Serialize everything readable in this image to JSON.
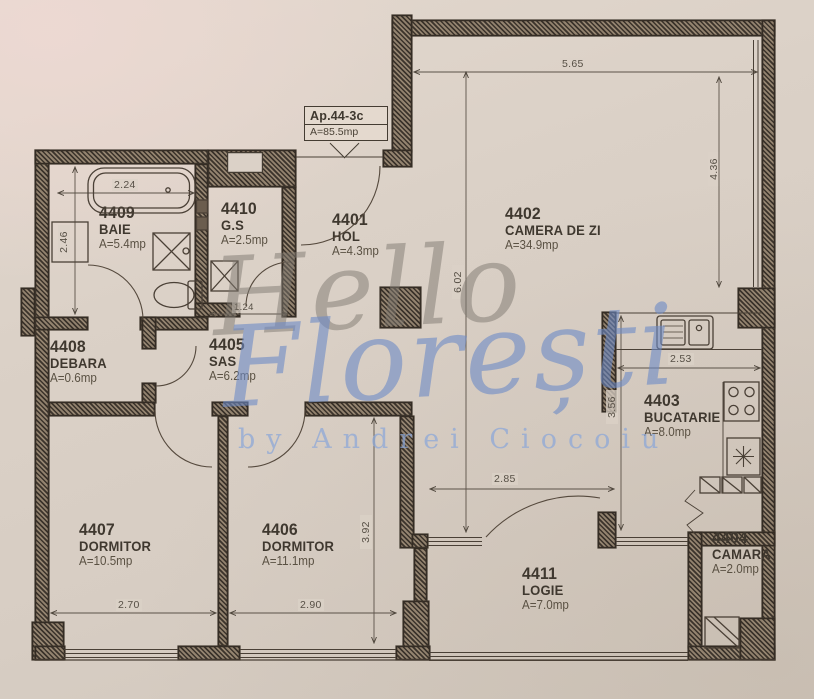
{
  "title": "Apartment floor plan",
  "apartment_tag": {
    "id": "Ap.44-3c",
    "area": "A=85.5mp"
  },
  "rooms": [
    {
      "id": "4409",
      "name": "BAIE",
      "area": "A=5.4mp"
    },
    {
      "id": "4410",
      "name": "G.S",
      "area": "A=2.5mp"
    },
    {
      "id": "4401",
      "name": "HOL",
      "area": "A=4.3mp"
    },
    {
      "id": "4402",
      "name": "CAMERA DE ZI",
      "area": "A=34.9mp"
    },
    {
      "id": "4408",
      "name": "DEBARA",
      "area": "A=0.6mp"
    },
    {
      "id": "4405",
      "name": "SAS",
      "area": "A=6.2mp"
    },
    {
      "id": "4403",
      "name": "BUCATARIE",
      "area": "A=8.0mp"
    },
    {
      "id": "4407",
      "name": "DORMITOR",
      "area": "A=10.5mp"
    },
    {
      "id": "4406",
      "name": "DORMITOR",
      "area": "A=11.1mp"
    },
    {
      "id": "4404",
      "name": "CAMARA",
      "area": "A=2.0mp"
    },
    {
      "id": "4411",
      "name": "LOGIE",
      "area": "A=7.0mp"
    }
  ],
  "dimensions": {
    "top_width": "5.65",
    "right_height": "4.36",
    "living_height": "6.02",
    "bath_width": "2.24",
    "bath_height": "2.46",
    "gs_width": "1.24",
    "kitchen_width": "2.53",
    "kitchen_height": "3.56",
    "logia_opening": "2.85",
    "bedroom2_height": "3.92",
    "bedroom1_width": "2.70",
    "bedroom2_width": "2.90"
  },
  "watermark": {
    "line1": "Hello",
    "line2": "Florești",
    "line3": "by Andrei Ciocoiu"
  },
  "colors": {
    "paper": "#d9cfc5",
    "wall": "#3b332b",
    "ink": "#3f382f",
    "watermark_blue": "#7d9fd6",
    "watermark_gray": "#8e877e"
  }
}
